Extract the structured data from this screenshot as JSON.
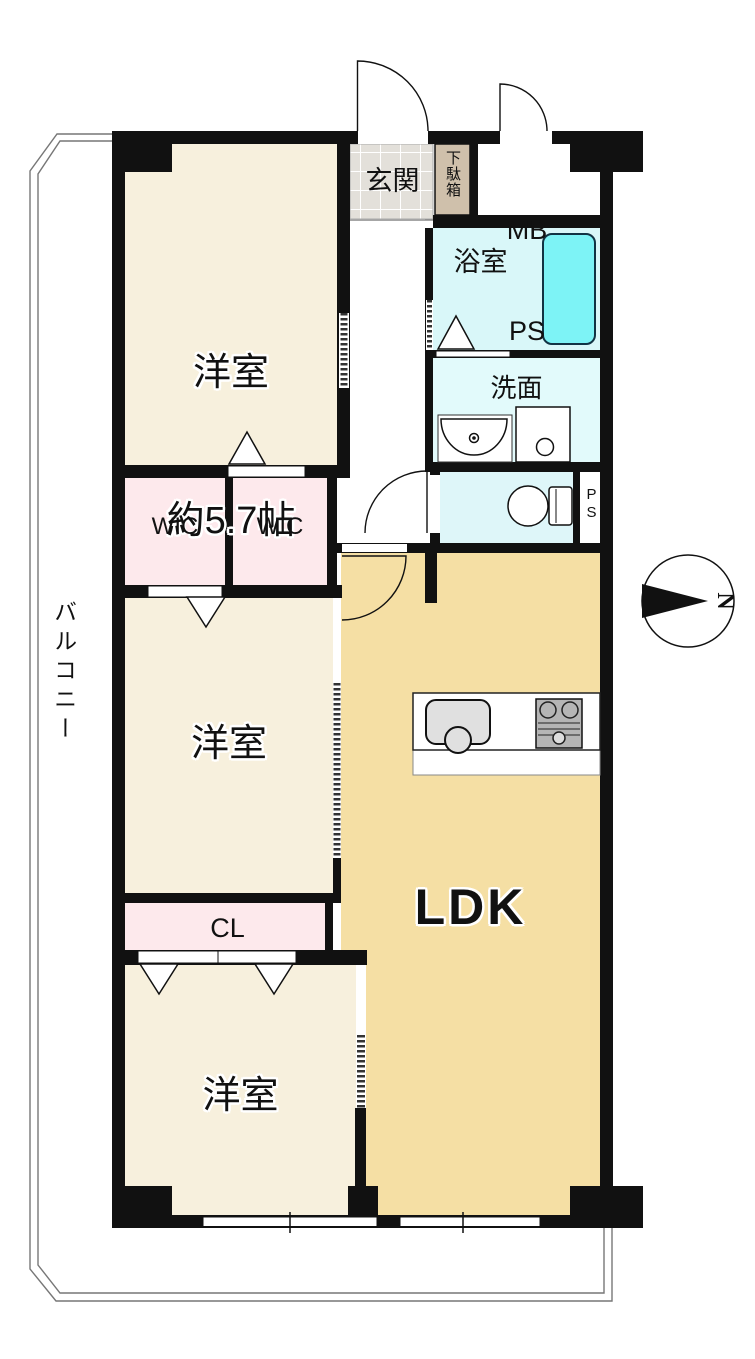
{
  "plan": {
    "rooms": {
      "bedroom_top": {
        "label": "洋室",
        "size": "約5.7帖"
      },
      "bedroom_middle": {
        "label": "洋室"
      },
      "bedroom_bottom": {
        "label": "洋室"
      },
      "ldk": {
        "label": "LDK"
      },
      "wic_left": {
        "label": "WIC"
      },
      "wic_right": {
        "label": "WIC"
      },
      "closet": {
        "label": "CL"
      },
      "entrance": {
        "label": "玄関"
      },
      "shoe_cabinet": {
        "label": "下駄箱"
      },
      "meter_box_pipe_space": {
        "line1": "MB",
        "line2": "PS"
      },
      "bathroom": {
        "label": "浴室"
      },
      "washroom": {
        "label": "洗面"
      },
      "pipe_space": {
        "label": "PS"
      },
      "balcony": {
        "label": "バルコニー"
      }
    },
    "compass": {
      "north_label": "N"
    },
    "colors": {
      "wall": "#111111",
      "bedroom_fill": "#f7f0dd",
      "ldk_fill": "#f5dfa4",
      "closet_fill": "#fde9ec",
      "bathroom_fill": "#d9f7f9",
      "washroom_fill": "#e2fafb",
      "toilet_fill": "#def6f9",
      "bathtub_fill": "#7df3f6",
      "entrance_tile_fill": "#e3e0da",
      "shoe_cabinet_fill": "#cfc0ab"
    }
  }
}
